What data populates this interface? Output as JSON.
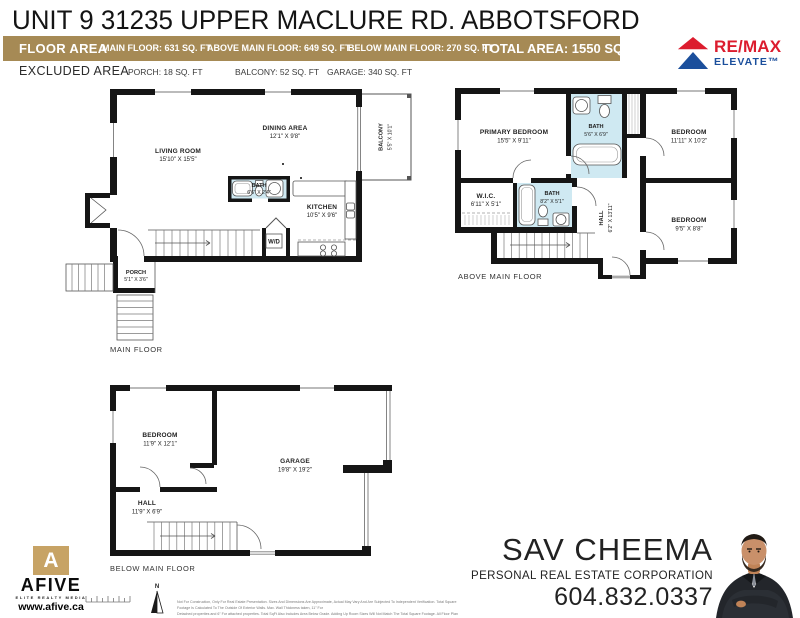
{
  "title": "UNIT 9 31235 UPPER MACLURE RD. ABBOTSFORD",
  "floor_area_bar": {
    "label": "FLOOR AREA",
    "main": "MAIN FLOOR: 631 SQ. FT",
    "above": "ABOVE MAIN FLOOR: 649 SQ. FT",
    "below": "BELOW MAIN FLOOR: 270 SQ. FT",
    "total": "TOTAL AREA: 1550 SQ. FT",
    "bg_color": "#a68a55"
  },
  "excluded": {
    "label": "EXCLUDED AREA",
    "porch": "PORCH: 18 SQ. FT",
    "balcony": "BALCONY: 52 SQ. FT",
    "garage": "GARAGE: 340 SQ. FT"
  },
  "remax": {
    "word": "RE/MAX",
    "sub": "ELEVATE™",
    "red": "#dc1c2e",
    "blue": "#1b4f9c"
  },
  "plans": {
    "main": {
      "caption": "MAIN FLOOR",
      "rooms": {
        "living": {
          "name": "LIVING ROOM",
          "dims": "15'10\" X 15'5\""
        },
        "dining": {
          "name": "DINING AREA",
          "dims": "12'1\" X 9'8\""
        },
        "balcony": {
          "name": "BALCONY",
          "dims": "5'5\" X 10'1\""
        },
        "bath": {
          "name": "BATH",
          "dims": "6'6\" X 2'4\""
        },
        "kitchen": {
          "name": "KITCHEN",
          "dims": "10'5\" X 9'6\""
        },
        "porch": {
          "name": "PORCH",
          "dims": "5'1\" X 3'6\""
        },
        "wd": "W/D"
      }
    },
    "above": {
      "caption": "ABOVE MAIN FLOOR",
      "rooms": {
        "primary": {
          "name": "PRIMARY BEDROOM",
          "dims": "15'5\" X 9'11\""
        },
        "bath1": {
          "name": "BATH",
          "dims": "5'6\" X 6'9\""
        },
        "bedroom1": {
          "name": "BEDROOM",
          "dims": "11'11\" X 10'2\""
        },
        "wic": {
          "name": "W.I.C.",
          "dims": "6'11\" X 5'1\""
        },
        "bath2": {
          "name": "BATH",
          "dims": "8'2\" X 5'1\""
        },
        "hall": {
          "name": "HALL",
          "dims": "6'2\" X 13'11\""
        },
        "bedroom2": {
          "name": "BEDROOM",
          "dims": "9'5\" X 8'8\""
        }
      }
    },
    "below": {
      "caption": "BELOW MAIN FLOOR",
      "rooms": {
        "bedroom": {
          "name": "BEDROOM",
          "dims": "11'9\" X 12'1\""
        },
        "garage": {
          "name": "GARAGE",
          "dims": "19'8\" X 19'2\""
        },
        "hall": {
          "name": "HALL",
          "dims": "11'9\" X 6'9\""
        }
      }
    }
  },
  "afive": {
    "glyph": "A",
    "name": "AFIVE",
    "tagline": "ELITE REALTY MEDIA",
    "website": "www.afive.ca",
    "gold": "#c7a365"
  },
  "compass": {
    "label": "N"
  },
  "agent": {
    "name": "SAV CHEEMA",
    "title": "PERSONAL REAL ESTATE CORPORATION",
    "phone": "604.832.0337"
  },
  "disclaimer": {
    "line1": "Not For Construction, Only For Real Estate Presentation. Sizes And Dimensions Are Approximate, Actual May Vary And Are Subjected To Independent Verification. Total Square Footage Is Calculated To The Outside Of Exterior Walls. Max. Wall Thickness taken, 11\" For",
    "line2": "Detached properties and 6\" For attached properties. Total SqFt Also Includes Area Below Grade. Adding Up Room Sizes Will Not Match The Total Square Footage. All Floor Plan Is Not To Scale. E&O Insured. Valid For One Year From Date Floor Plan Created. MAR 2024"
  },
  "colors": {
    "bath_blue": "#cfe9f2",
    "wall": "#151515"
  }
}
